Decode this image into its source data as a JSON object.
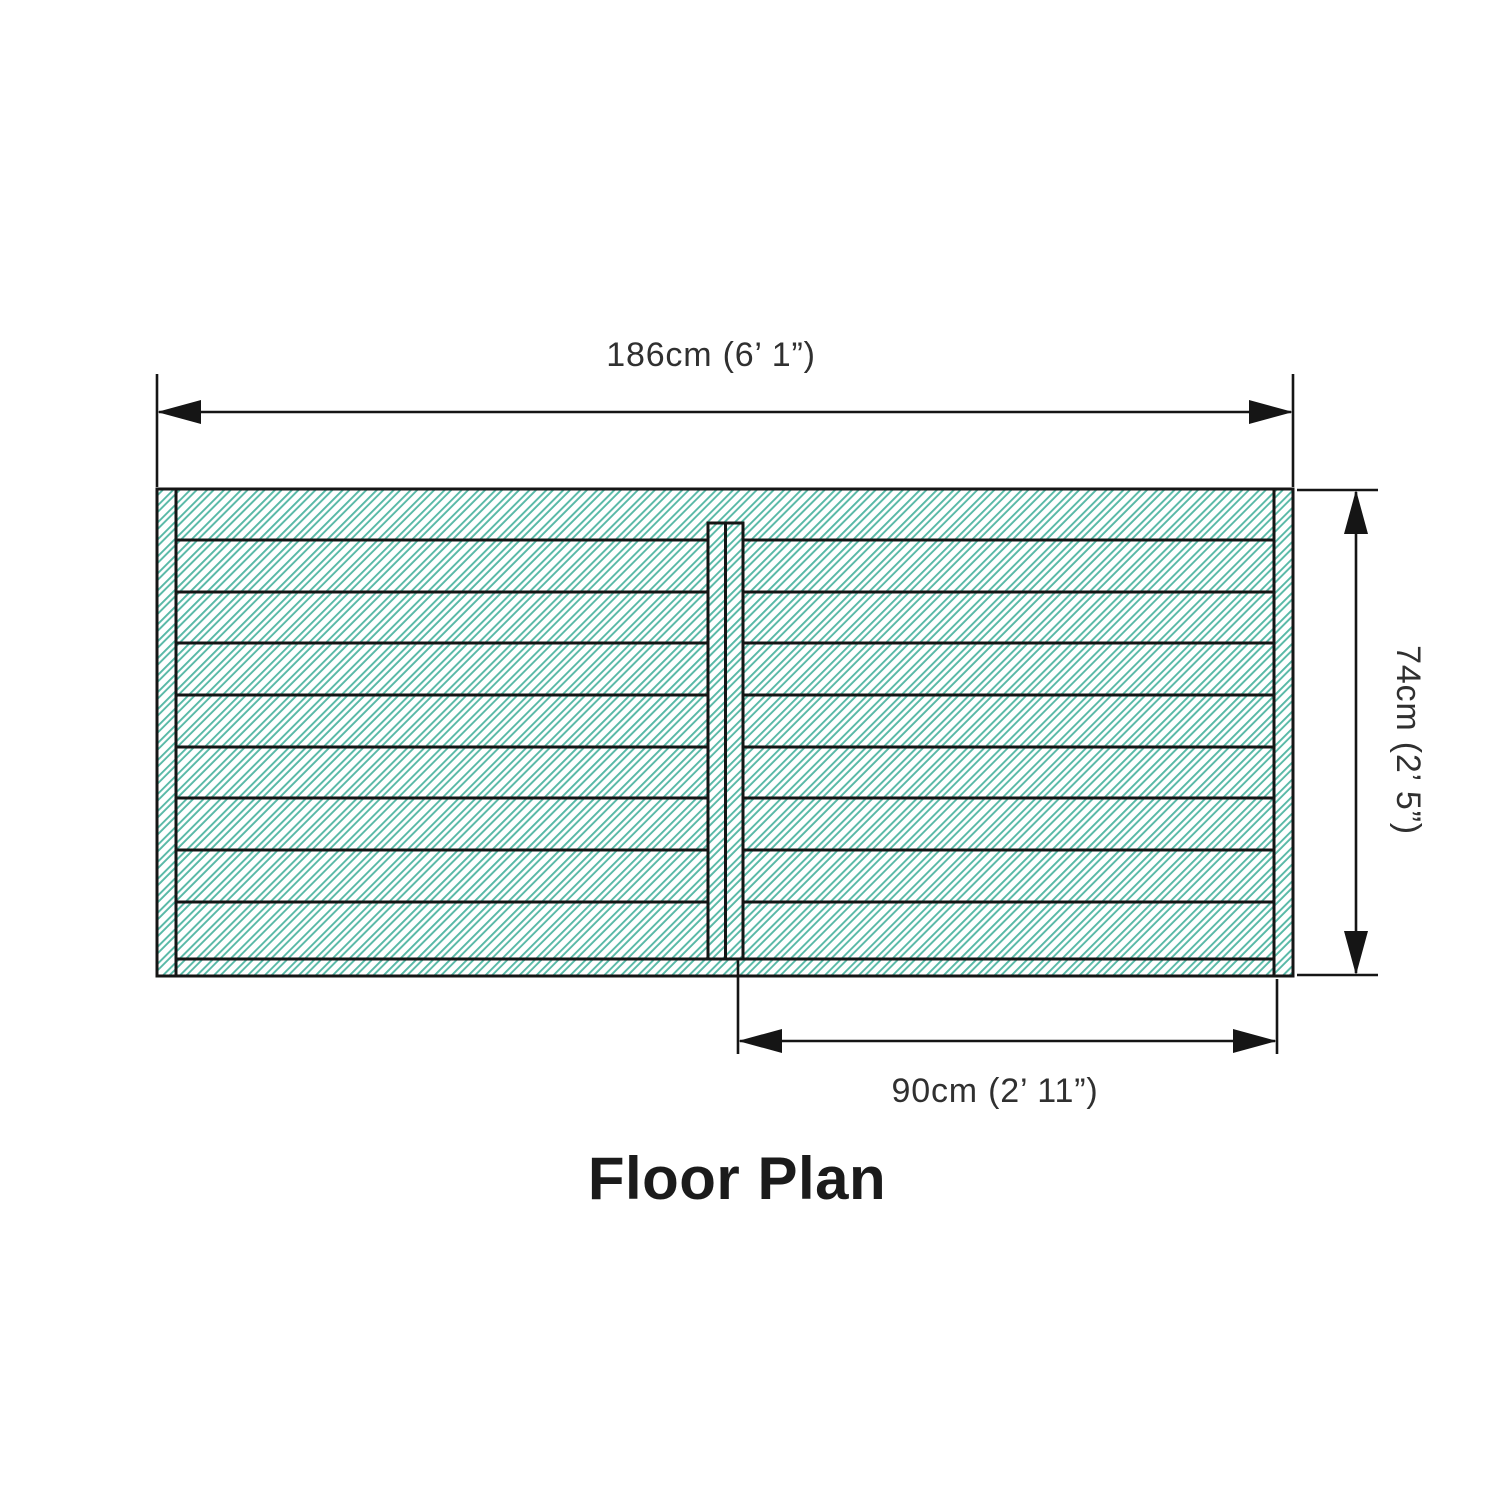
{
  "page": {
    "background": "#ffffff"
  },
  "diagram": {
    "title": "Floor Plan",
    "dimensions": {
      "width_label": "186cm (6’ 1”)",
      "height_label": "74cm (2’ 5”)",
      "door_label": "90cm (2’ 11”)"
    },
    "colors": {
      "hatch": "#57b8a6",
      "line": "#151515"
    }
  }
}
